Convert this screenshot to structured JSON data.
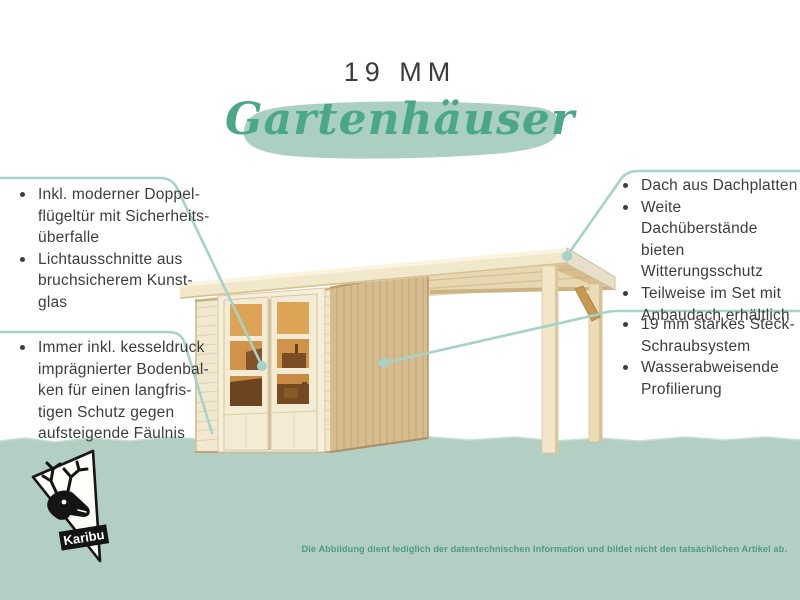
{
  "header": {
    "size_label": "19 MM",
    "category_title": "Gartenhäuser"
  },
  "features": {
    "left_top": [
      {
        "text": "Inkl. moderner Doppel-",
        "bullet": true
      },
      {
        "text": "flügeltür mit Sicherheits-",
        "bullet": false
      },
      {
        "text": "überfalle",
        "bullet": false
      },
      {
        "text": "Lichtausschnitte aus",
        "bullet": true
      },
      {
        "text": "bruchsicherem Kunst-",
        "bullet": false
      },
      {
        "text": "glas",
        "bullet": false
      }
    ],
    "left_bottom": [
      {
        "text": "Immer inkl. kesseldruck",
        "bullet": true
      },
      {
        "text": "imprägnierter Bodenbal-",
        "bullet": false
      },
      {
        "text": "ken für einen langfris-",
        "bullet": false
      },
      {
        "text": "tigen Schutz gegen",
        "bullet": false
      },
      {
        "text": "aufsteigende Fäulnis",
        "bullet": false
      }
    ],
    "right_top": [
      {
        "text": "Dach aus Dachplatten",
        "bullet": true
      },
      {
        "text": "Weite Dachüberstände",
        "bullet": true
      },
      {
        "text": "bieten Witterungsschutz",
        "bullet": false
      },
      {
        "text": "Teilweise im Set mit",
        "bullet": true
      },
      {
        "text": "Anbaudach erhältlich",
        "bullet": false
      }
    ],
    "right_middle": [
      {
        "text": "19 mm starkes Steck-",
        "bullet": true
      },
      {
        "text": "Schraubsystem",
        "bullet": false
      },
      {
        "text": "Wasserabweisende",
        "bullet": true
      },
      {
        "text": "Profilierung",
        "bullet": false
      }
    ]
  },
  "footer": {
    "disclaimer": "Die Abbildung dient lediglich der datentechnischen Information und bildet nicht den tatsächlichen Artikel ab.",
    "logo_label": "Karibu"
  },
  "icons": {
    "logo_icon": "deer-icon",
    "callout_marker": "dot-marker"
  },
  "colors": {
    "accent_green": "#4aa78a",
    "brush_green": "#abd0c1",
    "band_green": "#b3cec2",
    "callout_teal": "#a6d3c9",
    "text_dark": "#3d3d3b",
    "disclaimer_green": "#4f9c80",
    "wood_light": "#f1e8d0",
    "wood_side": "#d6bd90",
    "glass_amber": "#d1944a"
  }
}
